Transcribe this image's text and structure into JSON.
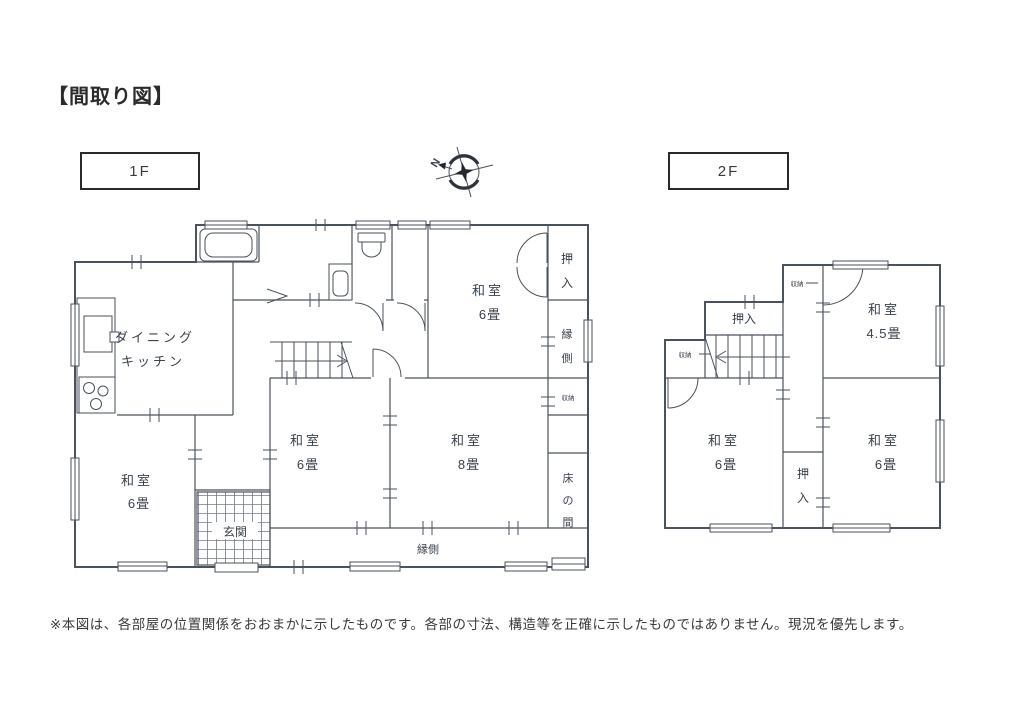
{
  "page": {
    "title": "【間取り図】",
    "disclaimer": "※本図は、各部屋の位置関係をおおまかに示したものです。各部の寸法、構造等を正確に示したものではありません。現況を優先します。",
    "line_color": "#4a525c",
    "text_color": "#39414b"
  },
  "compass": {
    "north_label": "N"
  },
  "icons": [
    "compass-rose-icon",
    "bathtub-icon",
    "toilet-icon",
    "washbasin-icon",
    "kitchen-sink-icon",
    "stove-icon",
    "staircase-icon",
    "entrance-tile-hatch",
    "door-arc",
    "window-marker"
  ],
  "floor1": {
    "tag": "1F",
    "rooms": {
      "dining_kitchen": {
        "line1": "ダイニング",
        "line2": "キッチン"
      },
      "washitsu6_ne": {
        "name": "和室",
        "size": "6畳"
      },
      "oshiire_e": {
        "c1": "押",
        "c2": "入"
      },
      "engawa_e": {
        "c1": "縁",
        "c2": "側"
      },
      "shunou_e": "収納",
      "washitsu6_c": {
        "name": "和室",
        "size": "6畳"
      },
      "washitsu8": {
        "name": "和室",
        "size": "8畳"
      },
      "tokonoma": {
        "c1": "床",
        "c2": "の",
        "c3": "間"
      },
      "washitsu6_sw": {
        "name": "和室",
        "size": "6畳"
      },
      "genkan": "玄関",
      "engawa_s": "縁側"
    }
  },
  "floor2": {
    "tag": "2F",
    "rooms": {
      "shunou_top": "収納",
      "oshiire_n": "押入",
      "shunou_w": "収納",
      "washitsu45": {
        "name": "和室",
        "size": "4.5畳"
      },
      "washitsu6_w": {
        "name": "和室",
        "size": "6畳"
      },
      "oshiire_s": {
        "c1": "押",
        "c2": "入"
      },
      "washitsu6_e": {
        "name": "和室",
        "size": "6畳"
      }
    }
  }
}
